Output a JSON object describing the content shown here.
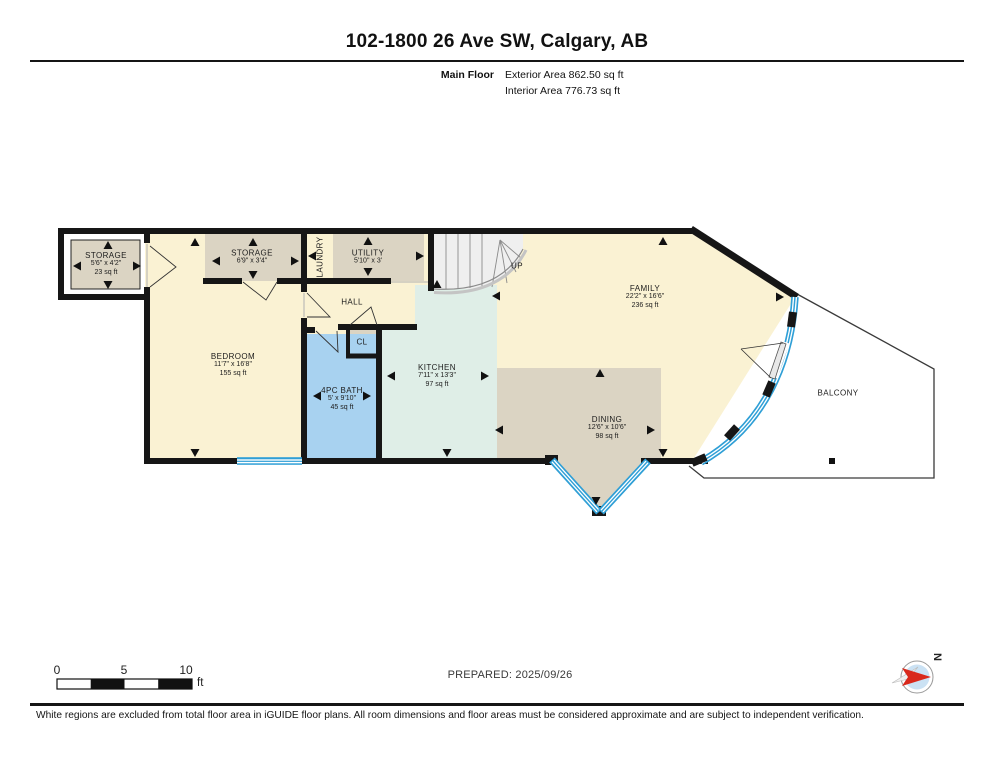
{
  "header": {
    "title": "102-1800 26 Ave SW, Calgary, AB",
    "floor_label": "Main Floor",
    "exterior_area": "Exterior Area 862.50 sq ft",
    "interior_area": "Interior Area 776.73 sq ft"
  },
  "rooms": {
    "storage_left": {
      "name": "STORAGE",
      "dims": "5'6\" x 4'2\"",
      "area": "23 sq ft"
    },
    "storage_2": {
      "name": "STORAGE",
      "dims": "6'9\" x 3'4\""
    },
    "laundry": {
      "name": "LAUNDRY"
    },
    "utility": {
      "name": "UTILITY",
      "dims": "5'10\" x 3'"
    },
    "stairs": {
      "label": "UP"
    },
    "hall": {
      "name": "HALL"
    },
    "closet": {
      "name": "CL"
    },
    "bedroom": {
      "name": "BEDROOM",
      "dims": "11'7\" x 16'8\"",
      "area": "155 sq ft"
    },
    "bath": {
      "name": "4PC BATH",
      "dims": "5' x 9'10\"",
      "area": "45 sq ft"
    },
    "kitchen": {
      "name": "KITCHEN",
      "dims": "7'11\" x 13'3\"",
      "area": "97 sq ft"
    },
    "dining": {
      "name": "DINING",
      "dims": "12'6\" x 10'6\"",
      "area": "98 sq ft"
    },
    "family": {
      "name": "FAMILY",
      "dims": "22'2\" x 16'6\"",
      "area": "236 sq ft"
    },
    "balcony": {
      "name": "BALCONY"
    }
  },
  "scale_bar": {
    "tick_0": "0",
    "tick_5": "5",
    "tick_10": "10",
    "unit": "ft"
  },
  "compass": {
    "label": "N"
  },
  "footer": {
    "prepared": "PREPARED: 2025/09/26",
    "disclaimer": "White regions are excluded from total floor area in iGUIDE floor plans. All room dimensions and floor areas must be considered approximate and are subject to independent verification."
  },
  "colors": {
    "wall": "#161616",
    "cream": "#FAF2D3",
    "tan": "#DBD4C3",
    "bath_blue": "#A8D2F0",
    "kitchen_teal": "#DFEEE7",
    "window_blue": "#2F9FD6",
    "stair_fill": "#EFEFEF",
    "compass_red": "#D9291C"
  }
}
